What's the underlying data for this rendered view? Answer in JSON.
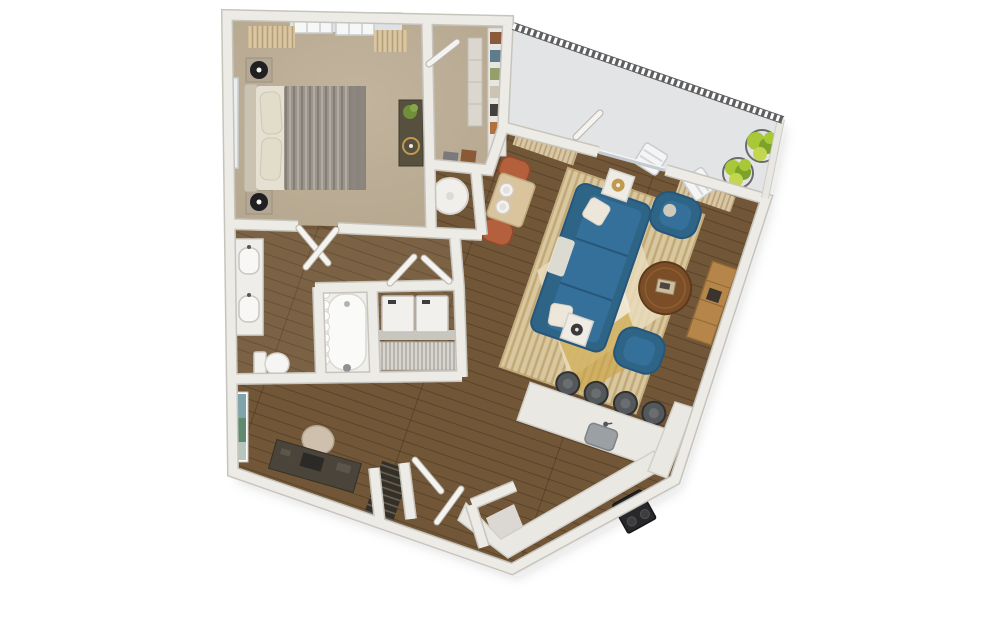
{
  "meta": {
    "scene": "3d-floor-plan-top-down-render",
    "canvas_width": 998,
    "canvas_height": 626,
    "background": "#ffffff"
  },
  "palette": {
    "wall_fill": "#edebe6",
    "wall_edge": "#c7c4bd",
    "wood_main": "#715637",
    "wood_light_overlay": "rgba(255,245,230,0.08)",
    "plank_line": "rgba(40,26,12,0.30)",
    "carpet": "#b5a68e",
    "carpet_hi": "#c2b49d",
    "balcony_floor": "#e2e4e5",
    "railing_dark": "#5f5f61",
    "sofa_blue": "#2e6486",
    "sofa_cushion": "#35709a",
    "sofa_shade": "#27567a",
    "pillow_cream": "#ece7da",
    "rug_base": "#d9c7a0",
    "rug_stripe": "rgba(173,143,84,0.55)",
    "rug_diamond_cream": "#e9dcbb",
    "rug_diamond_gold": "#c9a544",
    "rug_diamond_white": "#f2ead6",
    "rug_border": "#c4ad7e",
    "coffee_table_wood": "#7b4e28",
    "console_wood": "#b5854a",
    "dining_chair": "#b5603d",
    "dining_table": "#d9c49e",
    "counter_white": "#eae8e3",
    "counter_edge": "#d2cfc8",
    "sink_gray": "#9aa0a4",
    "stool_gray": "#55585a",
    "stove_black": "#28282a",
    "appliance_white": "#f1f0ed",
    "appliance_edge": "#c6c3bc",
    "wire_shelf": "#d8d5cf",
    "pantry_dark": "#343028",
    "pantry_shelf": "#6b6455",
    "plant_green": "#a9c838",
    "plant_green_dark": "#7da22a",
    "curtain_tan": "#d9c7a4",
    "curtain_rod_gold": "#c0974e",
    "desk_dark": "#4a443a",
    "office_chair_beige": "#cfc0ae",
    "duvet_gray": "#9b948a",
    "bedding_cream": "#e6e0d2",
    "headboard": "#cbc3b2",
    "nightstand": "#b3a795",
    "dresser_brown": "#57503f",
    "lamp_black": "#202022",
    "lamp_gold": "#c09a4e",
    "window_glass": "#e9eef0",
    "tub_white": "#f0efec",
    "art_blue": "#7fa3ab",
    "art_green": "#5f8a70",
    "shadow": "rgba(40,40,40,0.14)"
  },
  "rooms": {
    "bedroom": {
      "label": "bedroom"
    },
    "closet": {
      "label": "walk-in closet"
    },
    "nook": {
      "label": "table nook"
    },
    "bathroom": {
      "label": "bathroom"
    },
    "laundry": {
      "label": "laundry closet"
    },
    "hallway": {
      "label": "hallway"
    },
    "den": {
      "label": "den office"
    },
    "entry": {
      "label": "entry vestibule"
    },
    "dining": {
      "label": "dining nook"
    },
    "living": {
      "label": "living room"
    },
    "kitchen": {
      "label": "kitchen"
    },
    "balcony": {
      "label": "balcony"
    }
  },
  "furniture_counts": {
    "bar_stools": 4,
    "balcony_plants": 2,
    "balcony_chairs": 2,
    "dining_plates": 2,
    "laundry_machines": 2,
    "bedroom_nightstands": 2,
    "living_armchairs": 2
  }
}
